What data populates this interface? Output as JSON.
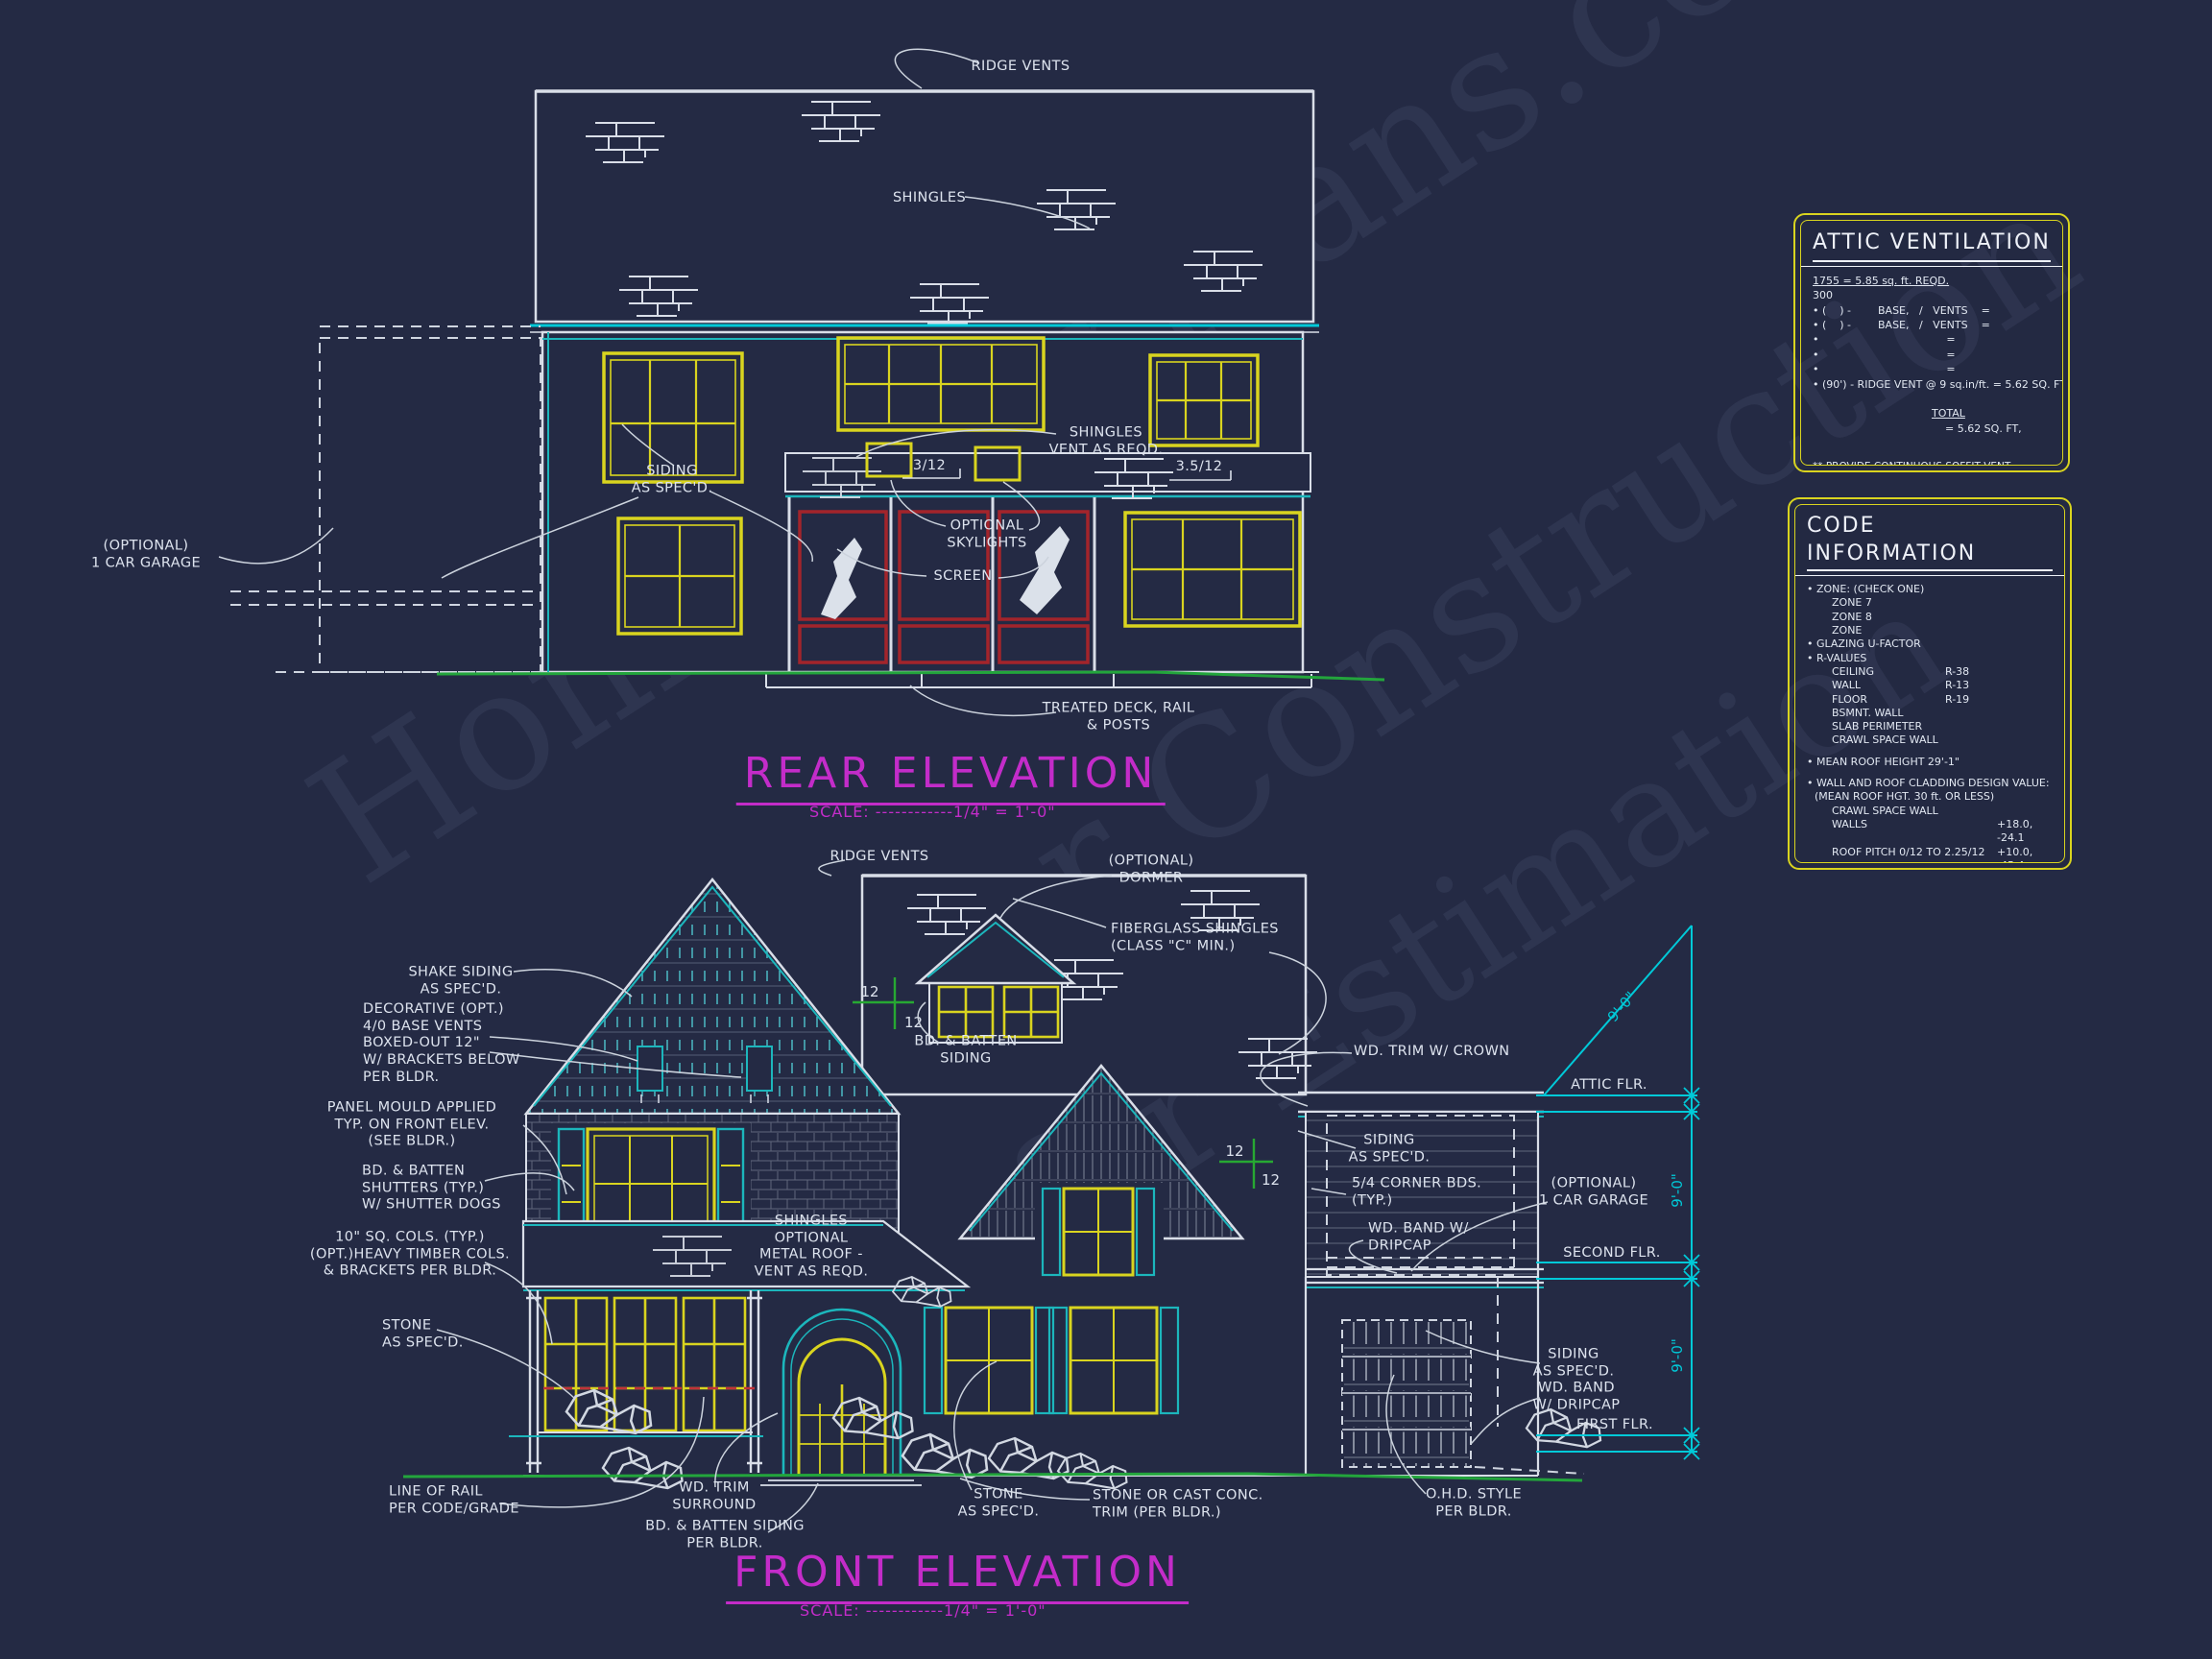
{
  "sheet": {
    "background": "#242a44",
    "line_white": "#d9dee8",
    "accent_cyan": "#1cb6bc",
    "floorline_cyan": "#00c9d8",
    "accent_yellow": "#d9d41f",
    "accent_magenta": "#c32cc9",
    "accent_red": "#a3242b",
    "accent_green": "#23a53c"
  },
  "watermark": {
    "lines": [
      "HomeFloorPlans.com",
      "for Construction",
      "for Estimation"
    ]
  },
  "rear": {
    "title": "REAR ELEVATION",
    "scale": "SCALE: ------------1/4\" = 1'-0\"",
    "labels": {
      "ridge_vents": "RIDGE VENTS",
      "shingles": "SHINGLES",
      "siding": "SIDING\nAS SPEC'D.",
      "shingles_vent": "SHINGLES\nVENT AS REQD.",
      "pitch_a": "3/12",
      "pitch_b": "3.5/12",
      "skylights": "OPTIONAL\nSKYLIGHTS",
      "screen": "SCREEN",
      "garage": "(OPTIONAL)\n1 CAR GARAGE",
      "deck": "TREATED DECK, RAIL\n& POSTS"
    }
  },
  "front": {
    "title": "FRONT ELEVATION",
    "scale": "SCALE: ------------1/4\" = 1'-0\"",
    "labels": {
      "ridge_vents": "RIDGE VENTS",
      "dormer": "(OPTIONAL)\nDORMER",
      "fiberglass": "FIBERGLASS SHINGLES\n(CLASS \"C\" MIN.)",
      "shake": "SHAKE SIDING\nAS SPEC'D.",
      "base_vents": "DECORATIVE (OPT.)\n4/0 BASE VENTS\nBOXED-OUT 12\"\nW/ BRACKETS BELOW\nPER BLDR.",
      "panel_mould": "PANEL MOULD APPLIED\nTYP. ON FRONT ELEV.\n(SEE BLDR.)",
      "shutters": "BD. & BATTEN\nSHUTTERS (TYP.)\nW/ SHUTTER DOGS",
      "cols": "10\" SQ. COLS. (TYP.)\n(OPT.)HEAVY TIMBER COLS.\n& BRACKETS PER BLDR.",
      "stone_left": "STONE\nAS SPEC'D.",
      "rail": "LINE OF RAIL\nPER CODE/GRADE",
      "trim_surround": "WD. TRIM\nSURROUND",
      "batten_siding_bldr": "BD. & BATTEN SIDING\nPER BLDR.",
      "stone_mid": "STONE\nAS SPEC'D.",
      "stone_cast": "STONE OR CAST CONC.\nTRIM (PER BLDR.)",
      "ohd": "O.H.D. STYLE\nPER BLDR.",
      "batten_dormer": "BD. & BATTEN\nSIDING",
      "porch_roof": "SHINGLES\nOPTIONAL\nMETAL ROOF -\nVENT AS REQD.",
      "trim_crown": "WD. TRIM W/ CROWN",
      "siding_mid": "SIDING\nAS SPEC'D.",
      "corner_bds": "5/4 CORNER BDS.\n(TYP.)",
      "band_dripcap_mid": "WD. BAND W/\nDRIPCAP",
      "garage": "(OPTIONAL)\n1 CAR GARAGE",
      "siding_low": "SIDING\nAS SPEC'D.",
      "band_dripcap_low": "WD. BAND\nW/ DRIPCAP",
      "attic_flr": "ATTIC FLR.",
      "second_flr": "SECOND FLR.",
      "first_flr": "FIRST FLR.",
      "dim1": "9'-0\"",
      "dim2": "9'-0\"",
      "dim3": "9'-0\"",
      "pitch12a_top": "12",
      "pitch12a_bot": "12",
      "pitch12b_top": "12",
      "pitch12b_bot": "12"
    }
  },
  "attic_box": {
    "title": "ATTIC VENTILATION",
    "req_top": "1755 = 5.85 sq. ft. REQD.",
    "req_den": "300",
    "rows": [
      "• (    ) -        BASE,   /   VENTS    =",
      "• (    ) -        BASE,   /   VENTS    =",
      "•                                      =",
      "•                                      =",
      "•                                      =",
      "• (90') - RIDGE VENT @ 9 sq.in/ft. = 5.62 SQ. FT,"
    ],
    "total_label": "TOTAL",
    "total_value": "= 5.62 SQ. FT,",
    "note2a": "** PROVIDE CONTINUOUS SOFFIT VENT SURROUND",
    "note2b": "TO EQUAL OR EXCEED  2.92 SQ. FT,",
    "note3a": "*** (OPT.) PROVIDE THEMOSTATICALLY CONTROLLED",
    "note3b": "POWER VENT TO EQUAL OR EXCEED  2.92 SQ. FT."
  },
  "code_box": {
    "title": "CODE INFORMATION",
    "zone_header": "• ZONE: (CHECK ONE)",
    "zones": [
      "ZONE 7",
      "ZONE 8",
      "ZONE"
    ],
    "glazing": "• GLAZING U-FACTOR",
    "rvalues_header": "• R-VALUES",
    "rvalues": [
      {
        "label": "CEILING",
        "value": "R-38"
      },
      {
        "label": "WALL",
        "value": "R-13"
      },
      {
        "label": "FLOOR",
        "value": "R-19"
      },
      {
        "label": "BSMNT. WALL",
        "value": ""
      },
      {
        "label": "SLAB PERIMETER",
        "value": ""
      },
      {
        "label": "CRAWL SPACE WALL",
        "value": ""
      }
    ],
    "mean_roof": "• MEAN ROOF HEIGHT  29'-1\"",
    "cladding_header": "• WALL AND ROOF CLADDING DESIGN VALUE:",
    "cladding_sub": "(MEAN ROOF HGT. 30 ft. OR LESS)",
    "cladding": [
      {
        "label": "CRAWL SPACE WALL",
        "value": ""
      },
      {
        "label": "WALLS",
        "value": "+18.0, -24.1"
      },
      {
        "label": "ROOF PITCH 0/12 TO 2.25/12",
        "value": "+10.0, -45.4"
      },
      {
        "label": "ROOF PITCH 2.25/12 TO 7/12",
        "value": "+10.4,-34.8"
      },
      {
        "label": "ROOF PITCH 7/12 TO 12/12",
        "value": "+16.5,-21.0"
      },
      {
        "label": "EXPOSURE ADJUSTMENT",
        "value": "x"
      }
    ]
  }
}
